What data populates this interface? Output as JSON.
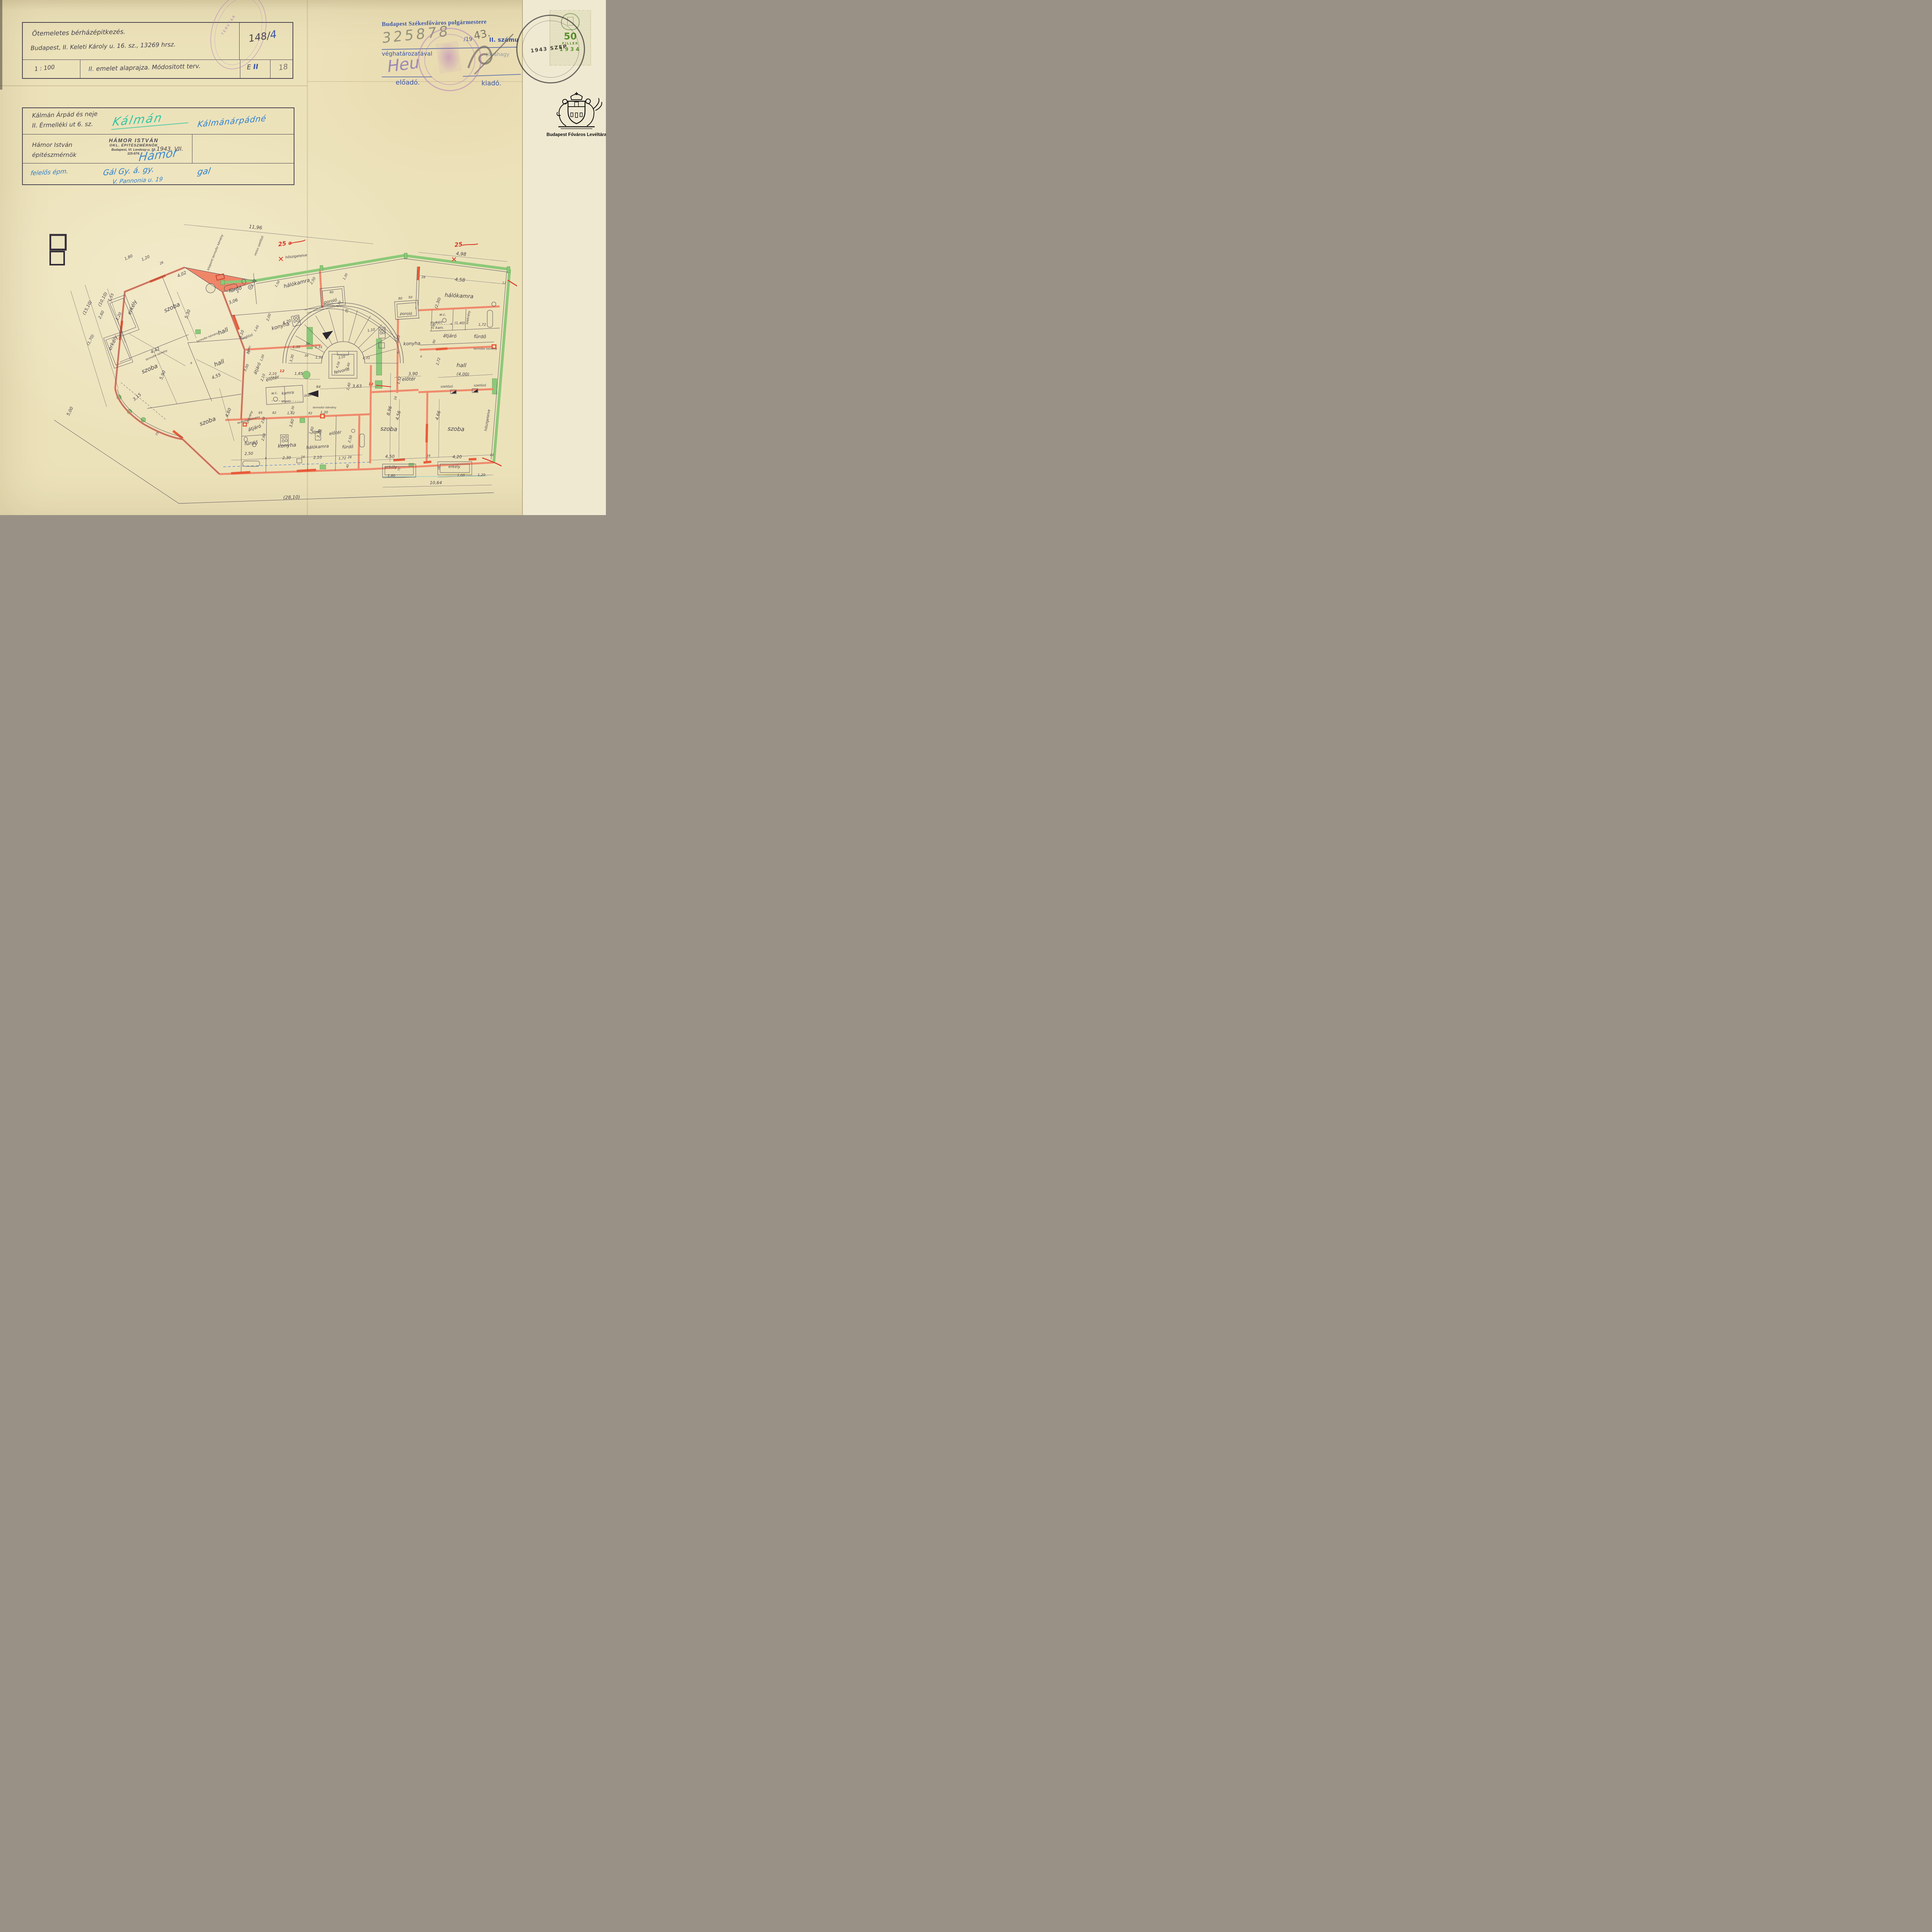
{
  "page": {
    "archive_caption": "Budapest Főváros Levéltára"
  },
  "block1": {
    "line1": "Ötemeletes bérházépitkezés.",
    "line2": "Budapest, II. Keleti Károly u. 16. sz., 13269 hrsz.",
    "file_no_main": "148/",
    "file_no_blue": "4",
    "scale": "1 : 100",
    "title_prefix_blue": "II.",
    "title_rest": " emelet alaprajza. Módositott terv.",
    "code_e": "E",
    "code_ii": "II",
    "page_pencil": "18",
    "oval_stamp_text": "TERVTÁR"
  },
  "approval": {
    "line1": "Budapest Székesfőváros polgármestere",
    "hand_number": "325878",
    "printed_per": "/19",
    "pencil_year": "43.",
    "printed_tail": "II. számu",
    "line3": "véghatározatával",
    "line3_right": "jóváhagy",
    "sig_left": "Heu",
    "label_left": "előadó.",
    "label_right": "kiadó."
  },
  "revenue": {
    "value": "50",
    "unit": "FILLÉR",
    "year": "1934",
    "cancel": "1943 SZEP"
  },
  "block2": {
    "owner1": "Kálmán Árpád és neje",
    "owner2": "II. Érmelléki ut 6. sz.",
    "sig_green": "Kálmán",
    "sig_blue": "Kálmánárpádné",
    "arch1": "Hámor István",
    "arch2": "épitészmérnök",
    "stamp1": "HÁMOR ISTVÁN",
    "stamp2": "OKL. ÉPITÉSZMÉRNÖK",
    "stamp3": "Budapest, VI. Lendvay-u. 10.",
    "stamp4": "115-674.",
    "sig_arch": "Hámor",
    "date": "1943. VII.",
    "resp1": "felelős épm.",
    "resp_sig": "Gál Gy. á. gy.",
    "resp_addr": "V. Pannonia u. 19",
    "resp_sig2": "gal"
  },
  "plan": {
    "labels": [
      [
        "erkély",
        218,
        312,
        -65,
        13
      ],
      [
        "szoba",
        319,
        315,
        -24,
        15
      ],
      [
        "hall",
        451,
        377,
        -22,
        15
      ],
      [
        "erkély",
        168,
        404,
        -65,
        13
      ],
      [
        "szoba",
        261,
        474,
        -22,
        15
      ],
      [
        "hall",
        441,
        459,
        -22,
        15
      ],
      [
        "szoba",
        411,
        610,
        -20,
        15
      ],
      [
        "fürdő",
        482,
        268,
        -16,
        13
      ],
      [
        "hálókamra",
        641,
        252,
        -14,
        13
      ],
      [
        "konyha",
        599,
        363,
        -16,
        13
      ],
      [
        "poroló",
        728,
        298,
        -12,
        11
      ],
      [
        "poroló",
        923,
        330,
        0,
        10
      ],
      [
        "hálókamra",
        1060,
        285,
        3,
        14
      ],
      [
        "w.c.",
        1018,
        332,
        0,
        9
      ],
      [
        "kam.",
        1010,
        366,
        0,
        9
      ],
      [
        "szekrény",
        1086,
        337,
        -80,
        8
      ],
      [
        "fürdő",
        1114,
        390,
        2,
        12
      ],
      [
        "átjáró",
        1036,
        388,
        2,
        12
      ],
      [
        "konyha",
        938,
        408,
        -2,
        12
      ],
      [
        "előtér",
        930,
        500,
        -2,
        12
      ],
      [
        "hall",
        1066,
        465,
        2,
        14
      ],
      [
        "(4,00)",
        1070,
        487,
        2,
        11
      ],
      [
        "felvonó",
        757,
        478,
        -14,
        11
      ],
      [
        "előtér",
        578,
        498,
        -14,
        12
      ],
      [
        "órák",
        669,
        541,
        -8,
        9
      ],
      [
        "főzőf.",
        694,
        636,
        -10,
        10
      ],
      [
        "előtér",
        740,
        639,
        -8,
        11
      ],
      [
        "w.c.",
        583,
        535,
        -6,
        9
      ],
      [
        "kamra",
        617,
        535,
        -6,
        10
      ],
      [
        "szekrény",
        520,
        596,
        -70,
        8
      ],
      [
        "szekr.",
        518,
        420,
        -68,
        8
      ],
      [
        "átjáró",
        541,
        470,
        -68,
        11
      ],
      [
        "átjáró",
        532,
        626,
        -18,
        12
      ],
      [
        "fürdő",
        522,
        666,
        -4,
        13
      ],
      [
        "konyha",
        615,
        672,
        -4,
        13
      ],
      [
        "hálókamra",
        694,
        675,
        -4,
        11
      ],
      [
        "fürdő",
        772,
        675,
        -2,
        11
      ],
      [
        "szoba",
        878,
        630,
        2,
        15
      ],
      [
        "szoba",
        1052,
        630,
        2,
        15
      ],
      [
        "erkély",
        884,
        727,
        0,
        10
      ],
      [
        "erkély",
        1048,
        726,
        0,
        10
      ],
      [
        "központi termofor kémény",
        431,
        169,
        -68,
        7.5
      ],
      [
        "vezuv szellőző",
        544,
        152,
        -68,
        7.5
      ],
      [
        "hőszigetelve",
        639,
        181,
        -6,
        9
      ],
      [
        "hőszigetelve",
        1136,
        603,
        -81,
        9
      ],
      [
        "termofor kémény",
        278,
        436,
        -24,
        7
      ],
      [
        "termofor kémény",
        410,
        390,
        -22,
        7
      ],
      [
        "termofor kémény",
        516,
        604,
        -16,
        7
      ],
      [
        "termofor kémény",
        712,
        572,
        0,
        7
      ],
      [
        "termofor kémény",
        1128,
        420,
        0,
        7
      ],
      [
        "szellőző",
        512,
        389,
        -20,
        8
      ],
      [
        "szellőző",
        1028,
        518,
        0,
        8
      ],
      [
        "szellőző",
        1114,
        515,
        0,
        8
      ],
      [
        "átszell.",
        613,
        556,
        0,
        7
      ],
      [
        "átszell.",
        998,
        352,
        0,
        7
      ],
      [
        "11,96",
        533,
        107,
        6,
        12
      ],
      [
        "1,80",
        206,
        184,
        -24,
        10
      ],
      [
        "1,20",
        250,
        186,
        -24,
        10
      ],
      [
        "28",
        291,
        198,
        -24,
        8
      ],
      [
        "4,02",
        344,
        228,
        -24,
        11
      ],
      [
        "(15,10)",
        101,
        313,
        -63,
        11
      ],
      [
        "(10,10)",
        141,
        291,
        -63,
        11
      ],
      [
        "1,55",
        162,
        286,
        -63,
        10
      ],
      [
        "2,60",
        137,
        331,
        -63,
        10
      ],
      [
        "1,20",
        182,
        335,
        -63,
        10
      ],
      [
        "(1,70)",
        109,
        396,
        -63,
        10
      ],
      [
        "5,00",
        56,
        581,
        -63,
        11
      ],
      [
        "5,30",
        361,
        329,
        -70,
        11
      ],
      [
        "3,06",
        477,
        298,
        -20,
        11
      ],
      [
        "6",
        488,
        273,
        0,
        7
      ],
      [
        "4,42",
        275,
        425,
        -24,
        11
      ],
      [
        "5,90",
        296,
        487,
        -68,
        11
      ],
      [
        "4,55",
        433,
        492,
        -22,
        11
      ],
      [
        "3,15",
        229,
        545,
        -40,
        11
      ],
      [
        "75",
        281,
        639,
        -60,
        8
      ],
      [
        "1,72",
        531,
        248,
        -65,
        9
      ],
      [
        "1,50",
        592,
        251,
        -60,
        8
      ],
      [
        "2,50",
        684,
        243,
        -60,
        9
      ],
      [
        "1,30",
        768,
        232,
        -63,
        8
      ],
      [
        "80",
        730,
        274,
        0,
        8
      ],
      [
        "1,50",
        751,
        303,
        -63,
        8
      ],
      [
        "4,20",
        615,
        351,
        -16,
        10
      ],
      [
        "2,00",
        570,
        337,
        -70,
        9
      ],
      [
        "4,10",
        500,
        381,
        -70,
        10
      ],
      [
        "1,00",
        553,
        442,
        -70,
        8
      ],
      [
        "1,85",
        645,
        485,
        0,
        10
      ],
      [
        "2,10",
        578,
        485,
        0,
        9
      ],
      [
        "3,30",
        630,
        443,
        -75,
        9
      ],
      [
        "1,30",
        639,
        416,
        0,
        9
      ],
      [
        "30",
        668,
        408,
        0,
        8
      ],
      [
        "1,31",
        697,
        416,
        0,
        9
      ],
      [
        "2,10",
        555,
        493,
        -70,
        9
      ],
      [
        "3,00",
        512,
        468,
        -65,
        9
      ],
      [
        "1,65",
        538,
        366,
        -60,
        8
      ],
      [
        "16",
        518,
        428,
        -60,
        8
      ],
      [
        "95",
        546,
        586,
        0,
        8
      ],
      [
        "82",
        582,
        586,
        0,
        8
      ],
      [
        "1,42",
        625,
        587,
        0,
        9
      ],
      [
        "82",
        675,
        587,
        0,
        8
      ],
      [
        "1,20",
        711,
        585,
        0,
        9
      ],
      [
        "230",
        556,
        603,
        -70,
        9
      ],
      [
        "1,30",
        631,
        575,
        -70,
        8
      ],
      [
        "1,60",
        681,
        630,
        -70,
        9
      ],
      [
        "84",
        696,
        519,
        0,
        9
      ],
      [
        "1,40",
        777,
        516,
        -75,
        9
      ],
      [
        "3,63",
        796,
        518,
        0,
        11
      ],
      [
        "2,10",
        757,
        442,
        -14,
        8
      ],
      [
        "4,56",
        749,
        460,
        -70,
        8
      ],
      [
        "1,60",
        775,
        463,
        -70,
        8
      ],
      [
        "1,31",
        698,
        443,
        0,
        9
      ],
      [
        "1,31",
        820,
        444,
        0,
        9
      ],
      [
        "30",
        665,
        438,
        0,
        8
      ],
      [
        "1,10",
        833,
        372,
        -10,
        9
      ],
      [
        "25",
        772,
        320,
        -75,
        8
      ],
      [
        "2,10",
        905,
        393,
        -75,
        9
      ],
      [
        "3,90",
        941,
        486,
        -2,
        11
      ],
      [
        "1,52",
        908,
        500,
        -75,
        9
      ],
      [
        "8,96",
        883,
        579,
        -75,
        11
      ],
      [
        "16",
        898,
        546,
        -75,
        8
      ],
      [
        "80",
        908,
        290,
        0,
        8
      ],
      [
        "50",
        934,
        287,
        0,
        8
      ],
      [
        "4,98",
        1065,
        176,
        5,
        12
      ],
      [
        "4,58",
        1062,
        243,
        5,
        12
      ],
      [
        "28",
        968,
        235,
        0,
        8
      ],
      [
        "12",
        1177,
        250,
        0,
        8
      ],
      [
        "(2,30)",
        1008,
        300,
        -70,
        10
      ],
      [
        "1,20",
        1008,
        352,
        0,
        8
      ],
      [
        "(1,40)",
        1062,
        354,
        0,
        9
      ],
      [
        "6",
        1040,
        356,
        0,
        7
      ],
      [
        "1,72",
        1120,
        358,
        0,
        9
      ],
      [
        "100",
        996,
        360,
        -70,
        8
      ],
      [
        "90",
        998,
        400,
        -70,
        8
      ],
      [
        "2,72",
        1009,
        451,
        -75,
        9
      ],
      [
        "6",
        962,
        440,
        0,
        7
      ],
      [
        "4,56",
        906,
        591,
        -75,
        11
      ],
      [
        "4,66",
        1009,
        591,
        -75,
        11
      ],
      [
        "4,50",
        881,
        700,
        0,
        11
      ],
      [
        "4,20",
        1055,
        701,
        0,
        11
      ],
      [
        "16",
        981,
        697,
        0,
        8
      ],
      [
        "12",
        1145,
        695,
        0,
        8
      ],
      [
        "28",
        1010,
        727,
        -75,
        7
      ],
      [
        "75",
        907,
        730,
        -75,
        7
      ],
      [
        "1,60",
        885,
        749,
        0,
        9
      ],
      [
        "1,60",
        1065,
        748,
        0,
        9
      ],
      [
        "1,20",
        1118,
        747,
        0,
        9
      ],
      [
        "10,64",
        1000,
        768,
        0,
        11
      ],
      [
        "(28,10)",
        627,
        806,
        -2,
        12
      ],
      [
        "2,50",
        516,
        692,
        -2,
        10
      ],
      [
        "2,30",
        614,
        703,
        -2,
        10
      ],
      [
        "2,10",
        694,
        702,
        -2,
        10
      ],
      [
        "1,72",
        758,
        704,
        -2,
        9
      ],
      [
        "3,60",
        630,
        611,
        -75,
        10
      ],
      [
        "3,20",
        701,
        638,
        -75,
        10
      ],
      [
        "2,60",
        557,
        647,
        -75,
        9
      ],
      [
        "2,50",
        781,
        652,
        -75,
        9
      ],
      [
        "4,60",
        466,
        584,
        -68,
        11
      ],
      [
        "16",
        656,
        700,
        0,
        8
      ],
      [
        "6",
        560,
        703,
        0,
        7
      ],
      [
        "40",
        774,
        722,
        -75,
        8
      ],
      [
        "28",
        777,
        701,
        0,
        8
      ],
      [
        "6",
        367,
        457,
        0,
        7
      ],
      [
        "6",
        902,
        430,
        0,
        7
      ],
      [
        "25 ⌀",
        610,
        150,
        -8,
        15,
        "red"
      ],
      [
        "✕",
        599,
        192,
        0,
        19,
        "red"
      ],
      [
        "25",
        1059,
        153,
        -5,
        15,
        "red"
      ],
      [
        "✕",
        1047,
        193,
        0,
        19,
        "red"
      ],
      [
        "12",
        602,
        478,
        0,
        9,
        "red"
      ],
      [
        "12",
        832,
        512,
        0,
        9,
        "red"
      ]
    ]
  }
}
